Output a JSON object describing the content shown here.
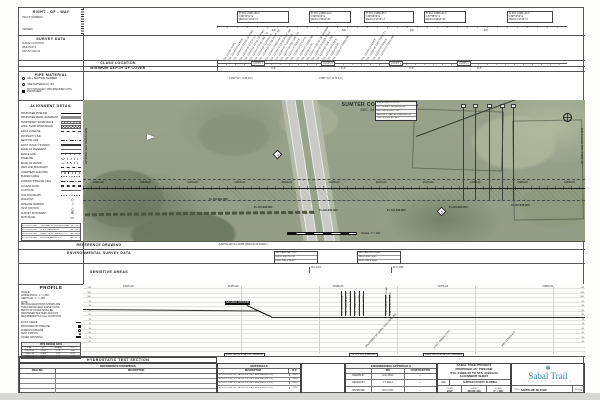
{
  "sections": {
    "row": {
      "title": "RIGHT - OF - WAY",
      "tract": "TRACT NUMBERS",
      "owners": "OWNERS"
    },
    "survey": {
      "title": "SURVEY DATA",
      "labels": [
        "SURVEY CONTROL",
        "MILE POSTS",
        "DATUM: NAD 83"
      ]
    },
    "class_loc": {
      "title": "CLASS LOCATION",
      "labels": [
        "CLASS 1",
        "CLASS 3",
        "CLASS 1",
        "CLASS 1"
      ]
    },
    "depth": {
      "title": "MINIMUM DEPTH OF COVER",
      "labels": [
        "3'-0\"",
        "4'-0\"",
        "3'-0\"",
        "3'-0\""
      ]
    },
    "pipe_mat": {
      "title": "PIPE MATERIAL",
      "legend": [
        {
          "sym": "circle",
          "label": "MILL SECTION NUMBER"
        },
        {
          "sym": "tick",
          "label": "SEE MATERIALS LIST"
        }
      ],
      "note": "NOT INSTALLED / NON-SPECIFIED UNTIL PURCHASED",
      "wt_notes": [
        "0.694\" W.T. (0.60 D.F.)",
        "0.580\" W.T. (0.72 D.F.)"
      ]
    },
    "align": {
      "title": "ALIGNMENT DETAIL",
      "items": [
        {
          "label": "PROPOSED PIPELINE",
          "sym": "solid"
        },
        {
          "label": "PROPOSED PERM. EASEMENT",
          "sym": "gray"
        },
        {
          "label": "TEMPORARY WORKSPACE",
          "sym": "hatch"
        },
        {
          "label": "ADDL. TEMP. WORKSPACE",
          "sym": "xhatch"
        },
        {
          "label": "EXIST. PIPELINE",
          "sym": "dash"
        },
        {
          "label": "PROPERTY LINE",
          "sym": "dashdot"
        },
        {
          "label": "SECTION LINE",
          "sym": "dashdotdot"
        },
        {
          "label": "EXIST. ROAD / HIGHWAY",
          "sym": "dbl"
        },
        {
          "label": "EDGE OF PAVEMENT",
          "sym": "thin"
        },
        {
          "label": "FENCE LINE",
          "sym": "fence"
        },
        {
          "label": "TREELINE",
          "sym": "scallop"
        },
        {
          "label": "EDGE OF WATER",
          "sym": "wave"
        },
        {
          "label": "WETLAND BOUNDARY",
          "sym": "dashw"
        },
        {
          "label": "OVERHEAD ELECTRIC",
          "sym": "ticks"
        },
        {
          "label": "BURIED CABLE",
          "sym": "dots"
        },
        {
          "label": "FOREIGN PIPELINE XING",
          "sym": "dashdot"
        },
        {
          "label": "ACCESS ROAD",
          "sym": "dbldash"
        },
        {
          "label": "CONTOUR",
          "sym": "thin"
        },
        {
          "label": "SOIL BOUNDARY",
          "sym": "dots"
        },
        {
          "label": "MILEPOST",
          "sym": "mp"
        },
        {
          "label": "PIPELINE MARKER",
          "sym": "mk"
        },
        {
          "label": "TEST STATION",
          "sym": "ts"
        },
        {
          "label": "SURVEY MONUMENT",
          "sym": "mon"
        },
        {
          "label": "MATCHLINE",
          "sym": "ml"
        }
      ],
      "table": [
        {
          "a": "FL-SU-031.000",
          "b": "CENTRAL FL. EXPRESSWAY",
          "c": "MP 416.1"
        },
        {
          "a": "FL-SU-033.000",
          "b": "D. & J. HARRISON",
          "c": "MP 416.5"
        },
        {
          "a": "FL-SU-034.000",
          "b": "STATE OF FLORIDA D.O.T.",
          "c": "MP 416.8"
        },
        {
          "a": "FL-SU-036.000",
          "b": "SUMTER FARMS LTD.",
          "c": "MP 417.3"
        }
      ]
    },
    "ref_dwg": {
      "title": "REFERENCE DRAWING",
      "note": "SABTRL-MP-SU-21883 (PREVIOUS SHEET)"
    },
    "env": {
      "title": "ENVIRONMENTAL SURVEY DATA",
      "box1": [
        "WETLAND PAL-1203",
        "XING LENGTH 120'",
        "RESTORE & SEED"
      ],
      "box2": [
        "WETLAND PFO-1188",
        "XING LENGTH 85'",
        "RESTORE & SEED"
      ]
    },
    "sensitive": {
      "title": "SENSITIVE AREAS",
      "tick1": "PAL-1203",
      "tick2": "PFO-1188"
    },
    "hydro": {
      "title": "HYDROSTATIC TEST SECTION"
    }
  },
  "top": {
    "boxes": [
      {
        "l1": "PI STA. 21941+86.3",
        "l2": "N 88°43'51\" E",
        "l3": "DELTA 0°41'22\" LT"
      },
      {
        "l1": "PI STA. 21950+12.0",
        "l2": "N 88°02'29\" E",
        "l3": "DELTA 1°05'40\" RT"
      },
      {
        "l1": "PI STA. 21958+65.7",
        "l2": "N 89°08'09\" E",
        "l3": "DELTA 1°12'18\" LT"
      },
      {
        "l1": "PI STA. 21966+02.4",
        "l2": "N 87°55'51\" E",
        "l3": "DELTA 0°58'03\" RT"
      },
      {
        "l1": "PI STA. 21981+44.9",
        "l2": "N 88°53'54\" E",
        "l3": "DELTA 0°47'36\" LT"
      }
    ],
    "dims": [
      "400'",
      "400'",
      "400'",
      "400'"
    ],
    "notes": [
      "STA. 21939+78 P/L",
      "STA. 21940+55 FENCE",
      "STA. 21941+32 EDGE OF PVMT.",
      "STA. 21941+96 DITCH CL",
      "STA. 21942+61 EDGE OF PVMT.",
      "STA. 21943+27 R/W LINE I-75",
      "STA. 21943+88 GUARDRAIL",
      "STA. 21944+50 EDGE PVMT. SB",
      "STA. 21945+14 MEDIAN CL",
      "STA. 21945+79 EDGE PVMT. NB",
      "STA. 21946+42 GUARDRAIL",
      "STA. 21947+08 R/W LINE I-75",
      "STA. 21947+70 FENCE",
      "STA. 21948+33 DITCH CL",
      "STA. 21948+97 TREELINE",
      "STA. 21949+60 P/L",
      "STA. 21950+24 EDGE OF WOODS",
      "STA. 21950+90 POWER POLE",
      "STA. 21951+55 OHE LINE",
      "STA. 21952+18 FENCE",
      "STA. 21952+84 P/L",
      "STA. 21953+47 TREELINE",
      "STA. 21968+14 FENCE",
      "STA. 21968+90 DIRT ROAD CL",
      "STA. 21969+55 FENCE",
      "STA. 21970+23 TREELINE"
    ]
  },
  "map": {
    "county": "SUMTER COUNTY, FLORIDA",
    "section": "SEC. 34 - T19S - R23E",
    "info": [
      "STA. 21953+25 CL I-75",
      "DOT PERMIT 2014-H-590-45",
      "HDD CROSSING - 285'",
      "SEE DWG. SABTRL-XING-SU-075",
      "TOP OF PIPE EL. 58.2'"
    ],
    "tracts": [
      "FL-SU-031.000",
      "FL-SU-032.000",
      "FL-SU-033.000",
      "FL-SU-034.000",
      "FL-SU-035.000",
      "FL-SU-036.000"
    ],
    "stations": [
      "21940+00",
      "21945+00",
      "21950+00",
      "21955+00",
      "21960+00",
      "21965+00",
      "21970+00",
      "21975+00",
      "21980+00",
      "21985+00",
      "21990+00"
    ],
    "diamonds": [
      "4",
      "5"
    ],
    "ml_left": "MATCHLINE STA. 21938+00",
    "ml_right": "MATCHLINE STA. 21993+00",
    "scale_note": "SCALE: 1\" = 400'"
  },
  "profile": {
    "title": "PROFILE",
    "scale_label": "SCALE:",
    "scale_h": "HORIZONTAL: 1\" = 400'",
    "scale_v": "VERTICAL: 1\" = 100'",
    "notes": [
      "NOTE:",
      "PROFILE ELEVATIONS SHOWN ARE",
      "TAKEN FROM FIELD SURVEY DATA.",
      "DEPTH OF COVER SHALL BE",
      "MAINTAINED PER FERC AND DOT",
      "REQUIREMENTS AT ALL LOCATIONS."
    ],
    "legend": [
      {
        "sym": "line",
        "label": "EXIST. GRADE"
      },
      {
        "sym": "square",
        "label": "PROPOSED 36\" PIPELINE"
      },
      {
        "sym": "circle",
        "label": "FOREIGN PIPELINE"
      },
      {
        "sym": "tri",
        "label": "TEST STATION"
      },
      {
        "sym": "dbl",
        "label": "CASED CROSSING"
      }
    ],
    "table_title": "PIPE DESIGN DATA",
    "table_head": [
      "STA.",
      "W.T.",
      "GRADE",
      "D.F."
    ],
    "table": [
      {
        "c1": "21938+00",
        "c2": "0.694\"",
        "c3": "X70",
        "c4": "0.60"
      },
      {
        "c1": "21956+40",
        "c2": "0.580\"",
        "c3": "X70",
        "c4": "0.72"
      },
      {
        "c1": "21993+00",
        "c2": "0.580\"",
        "c3": "X70",
        "c4": "0.72"
      }
    ],
    "elevs": [
      "110",
      "105",
      "100",
      "95",
      "90",
      "85",
      "80",
      "75",
      "70",
      "65",
      "60",
      "55",
      "50"
    ],
    "stations": [
      "21945+00",
      "21955+00",
      "21965+00",
      "21975+00",
      "21985+00"
    ],
    "ground_label": "NATURAL GROUND",
    "callouts_a": [
      "STA. 21952+10 EOP",
      "STA. 21952+88 SB I-75",
      "STA. 21953+45 MEDIAN",
      "STA. 21954+05 NB I-75",
      "STA. 21954+70 EOP",
      "STA. 21955+30 R/W"
    ],
    "callouts_b": [
      "STA. 21968+90 DIRT ROAD",
      "STA. 21970+23 FENCE"
    ],
    "callouts_below": [
      "PROPOSED 36\" SABAL TRAIL PIPELINE",
      "EXIST. GRADE (TYP.)",
      "MIN. COVER 3'-0\""
    ],
    "ml_boxes": [
      "DWG. MATCHLINE STA. 21938+00",
      "CL I-75 STA. 21953+25",
      "DWG. MATCHLINE STA. 21993+00"
    ]
  },
  "bottom": {
    "ref_table": {
      "title": "REFERENCE DRAWINGS",
      "col1": "DWG. NO.",
      "col2": "DESCRIPTION",
      "rows": [
        {
          "no": "",
          "desc": ""
        },
        {
          "no": "",
          "desc": ""
        },
        {
          "no": "",
          "desc": ""
        },
        {
          "no": "",
          "desc": ""
        }
      ]
    },
    "materials": {
      "title": "MATERIALS",
      "col1": "DESCRIPTION",
      "col2": "M.P.",
      "rows": [
        {
          "d": "36\" O.D. x 0.694\" W.T., API-5L-X70, PSL2, HFW, FBE (0.60 D.F.)",
          "mp": "416.4"
        },
        {
          "d": "36\" O.D. x 0.694\" W.T., API-5L-X70, PSL2, HFW, FBE (0.60 D.F.)",
          "mp": "416.6"
        },
        {
          "d": "36\" O.D. x 0.580\" W.T., API-5L-X70, PSL2, HFW, FBE (0.72 D.F.)",
          "mp": "416.9"
        },
        {
          "d": "36\" O.D. x 0.580\" W.T., API-5L-X70, PSL2, HFW, FBE (0.72 D.F.)",
          "mp": "417.4"
        }
      ]
    },
    "approvals": {
      "title": "ENGINEERING APPROVALS",
      "bid": "BID",
      "construction": "CONSTRUCTION",
      "rows": [
        {
          "l": "DRAWN BY",
          "b": "G.M. 05/14",
          "c": "—"
        },
        {
          "l": "DESIGN BY",
          "b": "J.T. 06/14",
          "c": "—"
        },
        {
          "l": "APPROVED",
          "b": "R.W. 07/14",
          "c": "—"
        }
      ]
    },
    "title_block": {
      "l1": "SABAL TRAIL PROJECT",
      "l2": "PROPOSED 36\" PIPELINE",
      "l3": "STA. 21938+00 TO STA. 21993+00",
      "l4": "ALIGNMENT SHEET",
      "use_label": "USE:",
      "county": "SUMTER COUNTY, FLORIDA",
      "year_label": "YEAR",
      "year": "2017",
      "sheet_label": "SHEET",
      "sheet": "420 OF 446",
      "scale_label": "SCALE",
      "scale": "1\" = 400'",
      "dwg_label": "DWG.",
      "dwg": "SABTRL-MP-SU-21938",
      "rev_label": "REV.",
      "rev": "0"
    },
    "logo": {
      "name": "Sabal Trail",
      "sub": "T R A N S M I S S I O N",
      "accent": "#2e7f99"
    }
  }
}
